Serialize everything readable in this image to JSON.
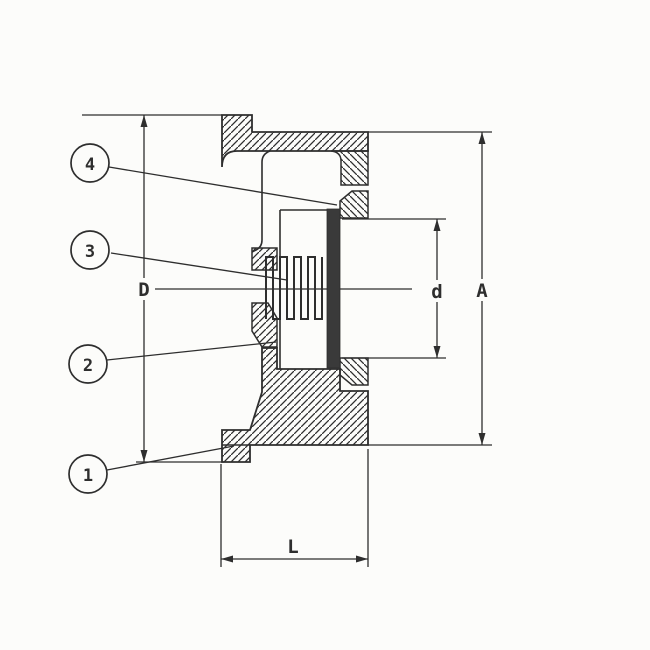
{
  "drawing": {
    "balloons": [
      {
        "label": "4"
      },
      {
        "label": "3"
      },
      {
        "label": "2"
      },
      {
        "label": "1"
      }
    ],
    "dimensions": {
      "flange_diameter": "D",
      "bore_diameter": "d",
      "outer_diameter": "A",
      "face_to_face": "L"
    },
    "colors": {
      "paper": "#fcfcfa",
      "ink": "#2e2e2e",
      "disc_fill": "#3a3a3a"
    }
  }
}
